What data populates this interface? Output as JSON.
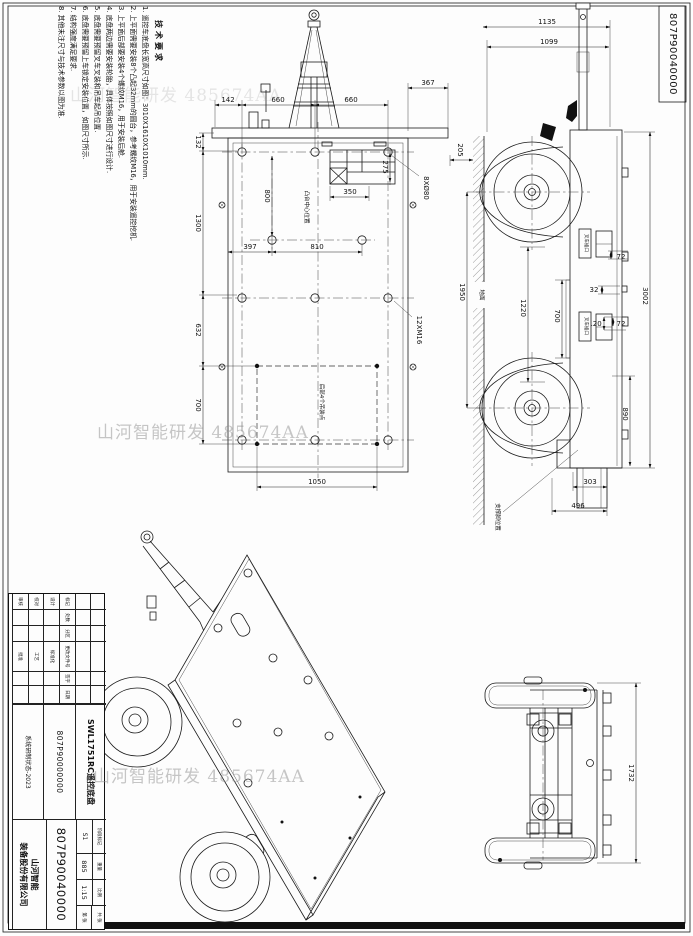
{
  "sheet": {
    "corner_drawing_no": "807P90040000",
    "watermark": "山河智能研发 485674AA"
  },
  "tech_requirements": {
    "title": "技术要求",
    "items": [
      "1. 遥控车底盘长宽高尺寸如图：3010X1610X1010mm.",
      "2. 上平面需要安装8个凸起32mm的圆台，参考螺纹M16，用于安装遥控挖机.",
      "3. 上平面后部要安装4个螺纹M16，用于安装后舱.",
      "4. 底盘两边需要安装轮胎，具体按照如图尺寸进行设计.",
      "5. 底盘需要预留叉车叉装和吊车起吊位置.",
      "6. 底盘需要预留上车锁定安装位置，如图尺寸所示.",
      "7. 结构强度满足要求.",
      "8. 其他未注尺寸与技术参数以图为准."
    ]
  },
  "top_view": {
    "dims": {
      "d142": "142",
      "d660a": "660",
      "d660b": "660",
      "d367": "367",
      "d132": "132",
      "d1300": "1300",
      "d632": "632",
      "d700": "700",
      "d800": "800",
      "d397": "397",
      "d810": "810",
      "d275": "275",
      "d350": "350",
      "d1050": "1050"
    },
    "callouts": {
      "bosses": "8XØ80",
      "threads": "12XM16",
      "panel_label": "凸台中心位置",
      "lift_label": "后部4个吊装点"
    }
  },
  "side_view": {
    "dims": {
      "d1135": "1135",
      "d1099": "1099",
      "d205": "205",
      "d1950": "1950",
      "d1220": "1220",
      "d700": "700",
      "d72a": "72",
      "d32": "32",
      "d120": "120",
      "d72b": "72",
      "d3002": "3002",
      "d890": "890",
      "d303": "303",
      "d496": "496"
    },
    "labels": {
      "ground": "地面",
      "fork_a": "叉车插口",
      "fork_b": "叉车插口",
      "support": "支撑脚位置"
    }
  },
  "rear_view": {
    "dims": {
      "d1732": "1732"
    }
  },
  "title_block": {
    "name": "SWL1751RC遥控底盘",
    "code": "807P90000000",
    "note": "系统研制状态-2023",
    "drawing_no": "807P90040000",
    "stage_value": "S1",
    "weight_value": "885",
    "scale_value": "1:15",
    "company_l1": "山河智能",
    "company_l2": "装备股份有限公司",
    "labels": {
      "mark": "标记",
      "qty": "处数",
      "zone": "分区",
      "doc": "更改文件号",
      "sign": "签字",
      "date": "日期",
      "design": "设计",
      "standard": "标准化",
      "check": "校对",
      "process": "工艺",
      "audit": "审核",
      "approve": "批准",
      "stage": "阶段标记",
      "weight": "重量",
      "scale": "比例",
      "total": "共 张",
      "page": "第 张"
    }
  }
}
